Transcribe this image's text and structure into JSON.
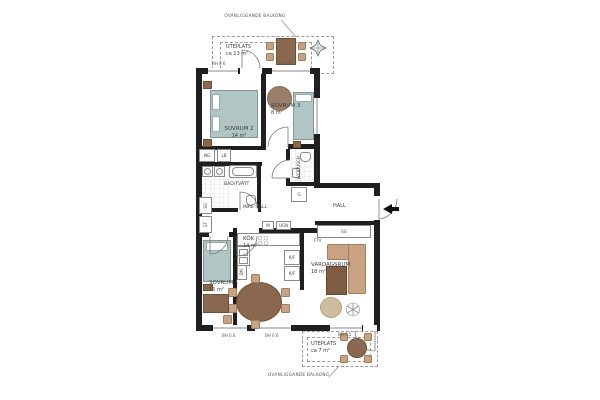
{
  "colors": {
    "wall": "#1f1f1f",
    "bed": "#b2c5c5",
    "wood_dark": "#8a6850",
    "wood_tan": "#c9a284",
    "rug_dark": "#7d5c41",
    "rug_jute": "#cdbd9e",
    "dash": "#9a9a9a"
  },
  "annotations": {
    "balcony_top": "OVANLIGGANDE BALKONG",
    "balcony_bottom": "OVANLIGGANDE BALKONG"
  },
  "terraces": {
    "top": {
      "name": "UTEPLATS",
      "area": "ca 13 m²"
    },
    "bottom": {
      "name": "UTEPLATS",
      "area": "ca 7 m²"
    }
  },
  "rooms": {
    "sovrum1": {
      "name": "SOVRUM 1",
      "area": "15 m²"
    },
    "sovrum2": {
      "name": "SOVRUM 2",
      "area": "14 m²"
    },
    "sovrum3": {
      "name": "SOVRUM 3",
      "area": "8 m²"
    },
    "kok": {
      "name": "KÖK",
      "area": "14 m²"
    },
    "vardagsrum": {
      "name": "VARDAGSRUM",
      "area": "18 m²"
    },
    "bad_tvatt": {
      "name": "BAD/TVÄTT"
    },
    "wc_dusch": {
      "name": "WC/DUSCH"
    },
    "inre_hall": {
      "name": "INRE HALL"
    },
    "hall": {
      "name": "HALL"
    }
  },
  "fixtures": {
    "ng": "NG",
    "lb": "LB",
    "sg_closet_left": "SG",
    "st": "ST",
    "g": "G",
    "sg_hall": "SG",
    "ftv": "FTV",
    "micro": "M",
    "ugn": "UGN",
    "kf_upper": "K/F",
    "kf_lower": "K/F",
    "dm": "DM"
  },
  "windows": {
    "top_left": "BH 0.6",
    "top_right": "BH 0.6",
    "bottom_left": "BH 0.6",
    "bottom_middle": "BH 0.6",
    "bottom_right": "BH 0.5"
  },
  "icons": {
    "compass": "compass-rose",
    "entrance_arrow": "entrance-arrow",
    "plant": "potted-plant"
  }
}
